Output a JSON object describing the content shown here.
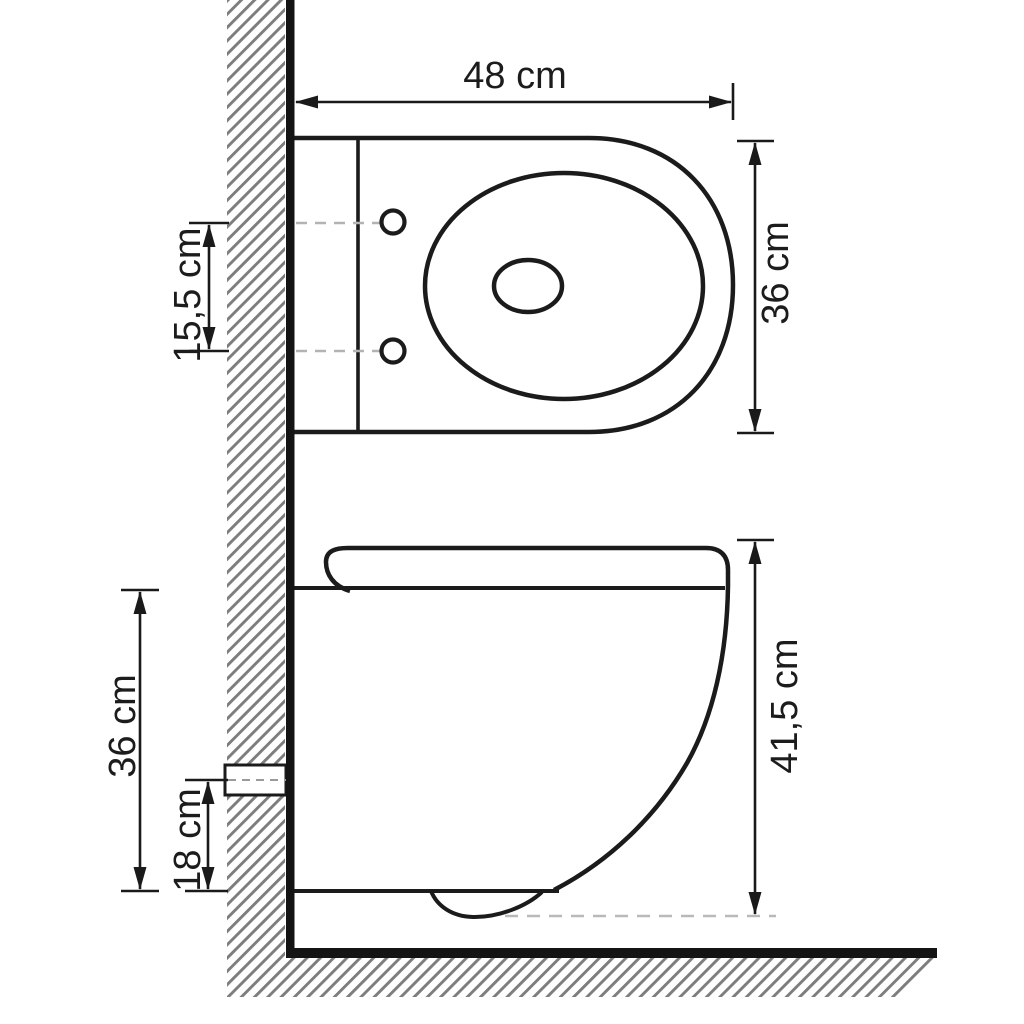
{
  "drawing": {
    "top_view": {
      "width_label": "48 cm",
      "depth_label": "36 cm",
      "hole_spacing_label": "15,5 cm"
    },
    "side_view": {
      "height_label": "41,5 cm",
      "depth_label": "36 cm",
      "outlet_height_label": "18 cm"
    },
    "colors": {
      "line": "#1b1b1b",
      "wall_black": "#141414",
      "hatch_gray": "#7d7d7d",
      "dash_gray": "#b3b3b3",
      "background": "#ffffff"
    }
  }
}
